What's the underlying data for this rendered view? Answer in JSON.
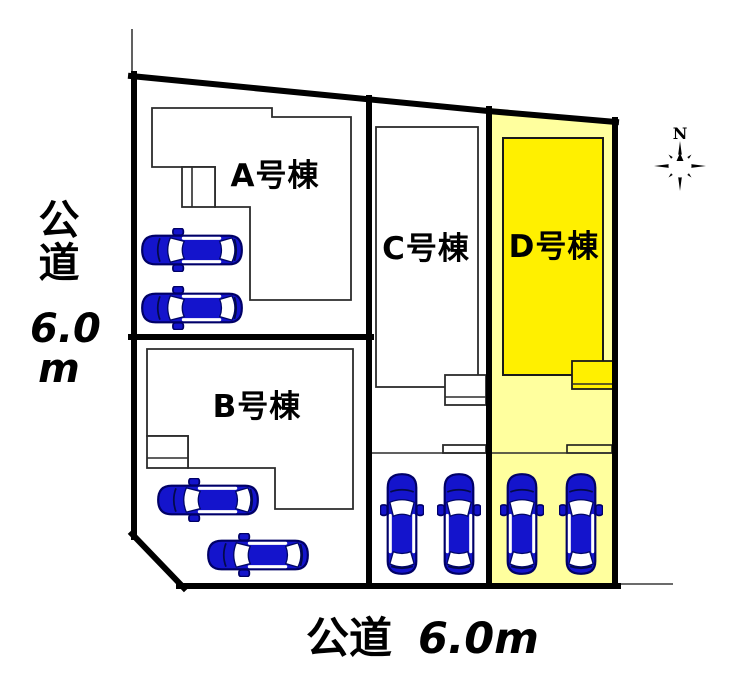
{
  "plan": {
    "title": "分譲地区画図",
    "buildings": [
      {
        "id": "A",
        "label": "A号棟",
        "parking_cars": 2,
        "highlighted": false
      },
      {
        "id": "B",
        "label": "B号棟",
        "parking_cars": 2,
        "highlighted": false
      },
      {
        "id": "C",
        "label": "C号棟",
        "parking_cars": 2,
        "highlighted": false
      },
      {
        "id": "D",
        "label": "D号棟",
        "parking_cars": 2,
        "highlighted": true
      }
    ],
    "roads": {
      "left": {
        "name": "公道",
        "width_value": "6.0",
        "width_unit": "m"
      },
      "bottom": {
        "name": "公道",
        "width_label": "6.0m"
      }
    },
    "compass": {
      "north_label": "N"
    },
    "total_cars": 8
  },
  "colors": {
    "car_blue": "#1414CC",
    "plot_d_highlight": "#FFFF9E",
    "building_d_fill": "#FFF000",
    "boundary_black": "#000000"
  }
}
